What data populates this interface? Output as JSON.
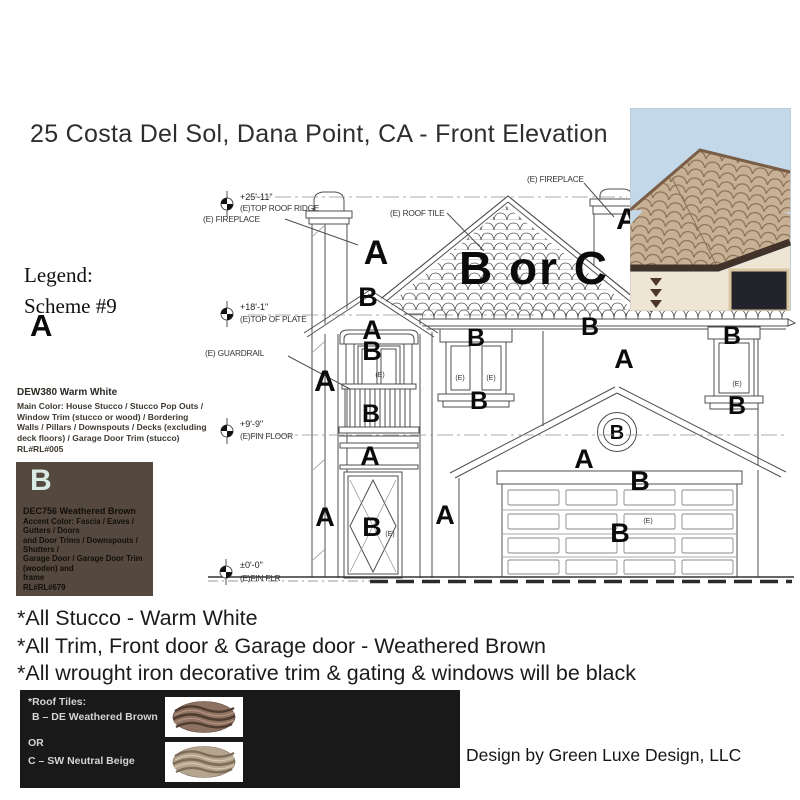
{
  "title": "25 Costa Del Sol, Dana Point, CA - Front Elevation",
  "legend": {
    "heading": "Legend:",
    "scheme": "Scheme #9",
    "a": {
      "letter": "A",
      "name": "DEW380 Warm White",
      "desc_lines": [
        "Main Color: House Stucco / Stucco Pop Outs /",
        "Window Trim (stucco or wood) / Bordering",
        "Walls / Pillars / Downspouts / Decks (excluding",
        "deck floors) / Garage Door Trim (stucco)",
        "RL#RL#005"
      ]
    },
    "b": {
      "letter": "B",
      "name": "DEC756 Weathered Brown",
      "desc_lines": [
        "Accent Color: Fascia / Eaves / Gutters / Doors",
        "and Door Trims / Downspouts / Shutters /",
        "Garage Door / Garage Door Trim (wooden) and",
        "frame",
        "RL#RL#679"
      ],
      "swatch_color": "#55493f"
    }
  },
  "notes": [
    "*All Stucco - Warm White",
    "*All Trim, Front door & Garage door - Weathered Brown",
    "*All wrought iron decorative trim & gating & windows will be black"
  ],
  "roof_tiles_box": {
    "heading": "*Roof Tiles:",
    "option_b": "B – DE Weathered Brown",
    "or": "OR",
    "option_c": "C – SW Neutral Beige"
  },
  "credit": "Design by Green Luxe Design, LLC",
  "drawing": {
    "marker_a": "A",
    "marker_b": "B",
    "marker_boc": "B or C",
    "marker_e": "(E)",
    "dims": {
      "ridge_val": "+25'-11\"",
      "ridge_label": "(E)TOP ROOF RIDGE",
      "fireplace": "(E) FIREPLACE",
      "roof_tile": "(E) ROOF TILE",
      "plate_val": "+18'-1\"",
      "plate_label": "(E)TOP OF PLATE",
      "guardrail": "(E) GUARDRAIL",
      "floor_val": "+9'-9\"",
      "floor_label": "(E)FIN FLOOR",
      "ground_val": "±0'-0\"",
      "ground_label": "(E)FIN FLR"
    }
  },
  "colors": {
    "swatch_b": "#55493f",
    "black_box": "#191919",
    "tile_brown": "#8d7161",
    "tile_beige": "#b5a48e",
    "b_letter": "#d9e9e3"
  }
}
